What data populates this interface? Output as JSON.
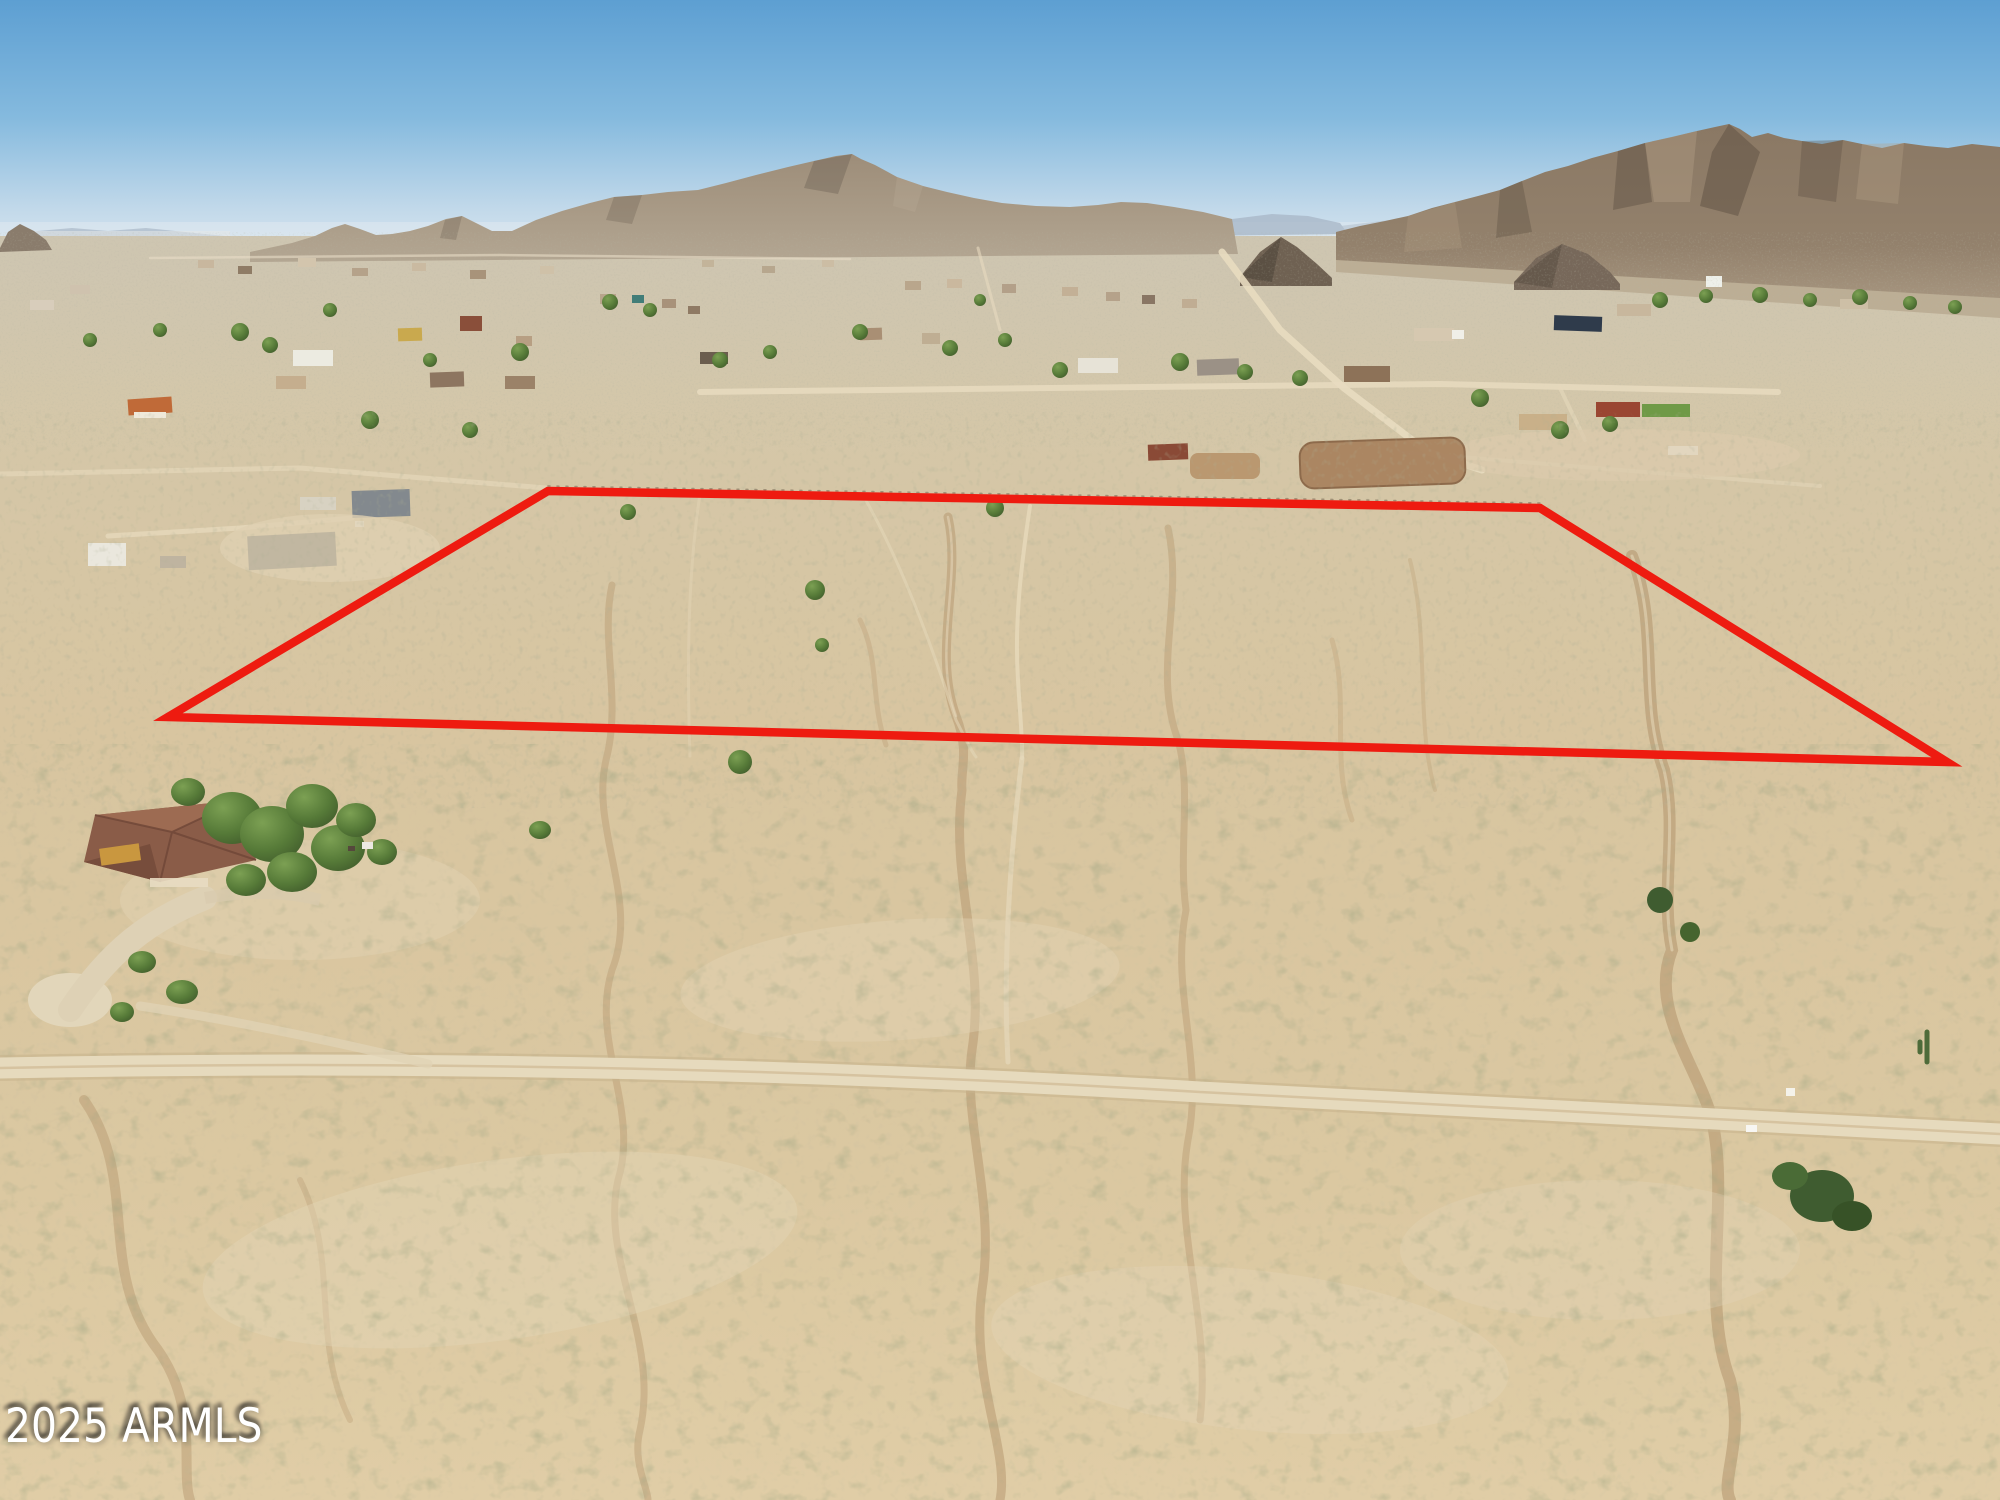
{
  "photo": {
    "kind": "aerial-drone-photo",
    "description": "Aerial view of vacant Sonoran desert acreage outlined in red, surrounded by scattered rural homes, dirt roads, braided desert washes and rocky mountain ranges on the horizon under a clear blue sky.",
    "watermark": {
      "text": "2025 ARMLS",
      "color": "#ffffff"
    }
  },
  "boundary": {
    "color": "#ee1b10",
    "stroke_width": 8.5,
    "vertices": [
      [
        548,
        491
      ],
      [
        1540,
        508
      ],
      [
        1947,
        762
      ],
      [
        168,
        717
      ]
    ]
  },
  "palette": {
    "sky_top": "#5d9fd2",
    "sky_mid": "#8abde0",
    "sky_horizon": "#dde8f0",
    "mountain_far_haze": "#a9b8c8",
    "mountain_left": "#a3937e",
    "mountain_right": "#8d7b67",
    "mountain_shadow": "#584c3f",
    "desert_distant": "#d2c6ae",
    "desert_mid": "#d8c6a2",
    "desert_foreground": "#dcc8a0",
    "dirt_road": "#e6d9bc",
    "wash": "#b99b74",
    "shrub_olive": "#5f6b42",
    "tree_green": "#4a6630",
    "roof_orange": "#c06a38",
    "roof_charcoal": "#4e565e",
    "arena_dirt": "#a9835f"
  }
}
